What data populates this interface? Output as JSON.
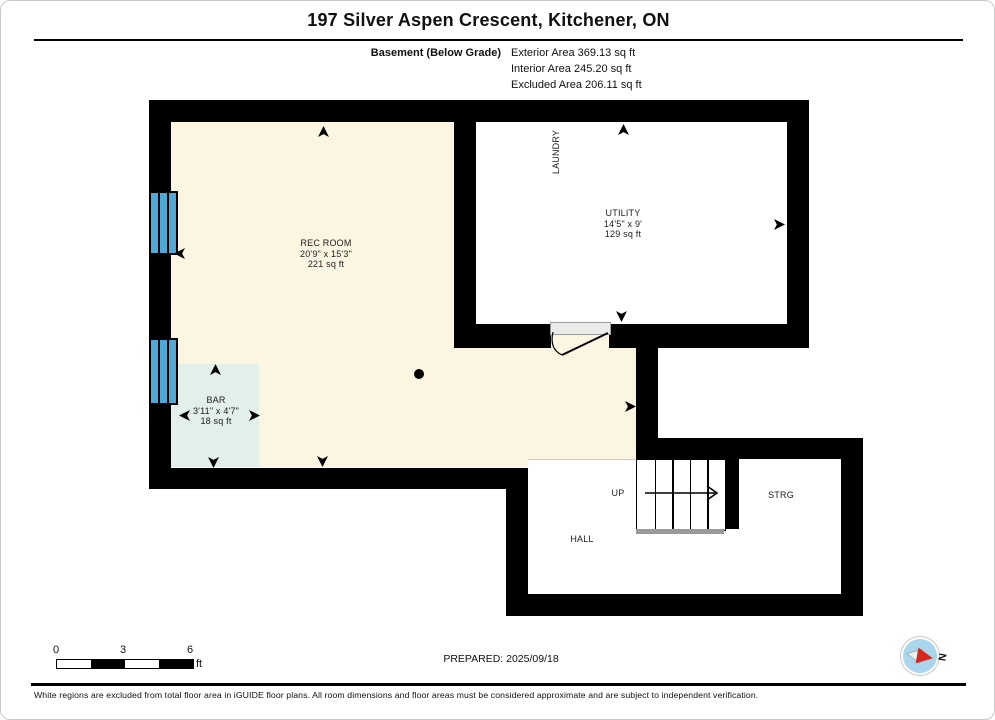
{
  "header": {
    "title": "197 Silver Aspen Crescent, Kitchener, ON",
    "floor_label": "Basement (Below Grade)",
    "areas": [
      "Exterior Area 369.13 sq ft",
      "Interior Area 245.20 sq ft",
      "Excluded Area 206.11 sq ft"
    ]
  },
  "plan": {
    "rec_room": {
      "name": "REC ROOM",
      "dims": "20'9\" x 15'3\"",
      "area": "221 sq ft"
    },
    "utility": {
      "name": "UTILITY",
      "dims": "14'5\" x 9'",
      "area": "129 sq ft"
    },
    "bar": {
      "name": "BAR",
      "dims": "3'11\" x 4'7\"",
      "area": "18 sq ft"
    },
    "laundry_label": "LAUNDRY",
    "hall_label": "HALL",
    "storage_label": "STRG",
    "stairs_label": "UP"
  },
  "scale_bar": {
    "tick_0": "0",
    "tick_3": "3",
    "tick_6": "6",
    "unit": "ft"
  },
  "prepared_label": "PREPARED: 2025/09/18",
  "compass_label": "N",
  "disclaimer": "White regions are excluded from total floor area in iGUIDE floor plans. All room dimensions and floor areas must be considered approximate and are subject to independent verification.",
  "colors": {
    "wall": "#000000",
    "floor-cream": "#FCF5E2",
    "bar-teal": "#E3F0EA",
    "window-blue": "#4FA8D5",
    "door-sill": "#EBEBE9",
    "compass-red": "#D6281E",
    "compass-blue": "#A9D6EC"
  }
}
